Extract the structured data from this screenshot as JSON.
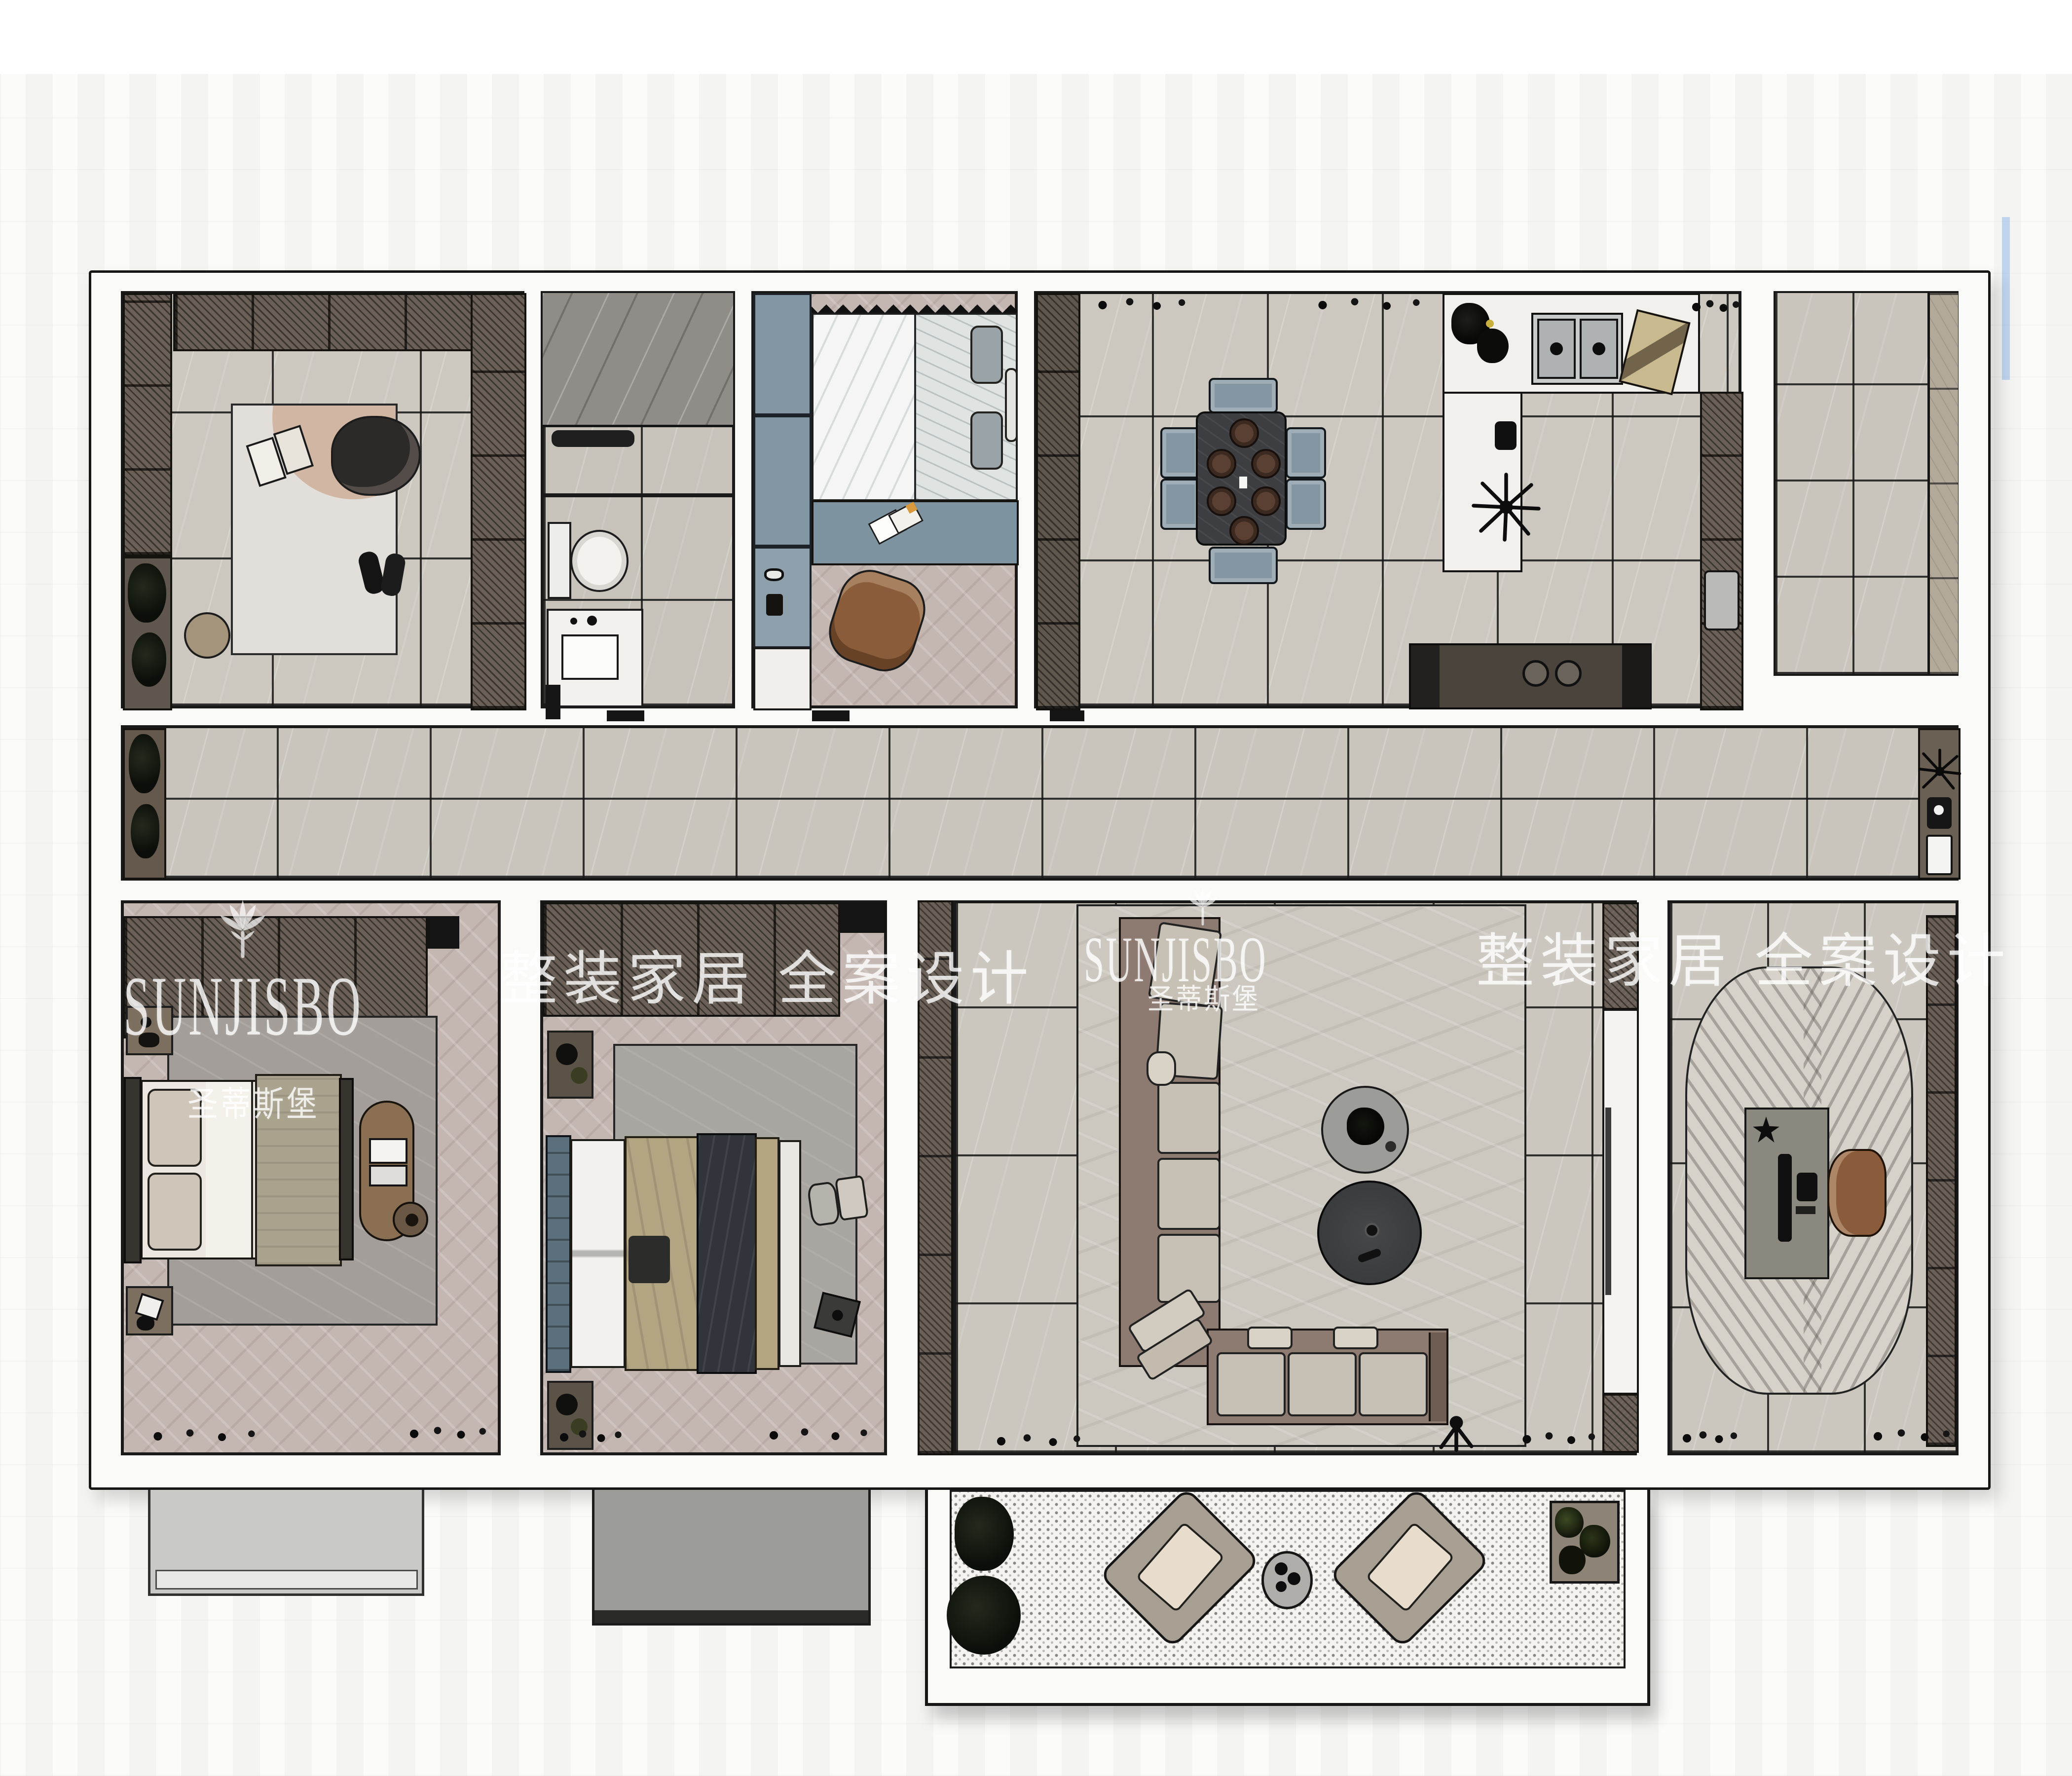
{
  "watermarks": {
    "brand": "SUNJISBO",
    "brand_cn": "圣蒂斯堡",
    "slogan": "整装家居 全案设计"
  },
  "palette": {
    "background": "#f7f7f5",
    "wall_fill": "#fafaf8",
    "wall_line": "#161616",
    "tile_floor": "#cbc7bf",
    "herringbone_floor": "#c4b7b2",
    "dark_shower_marble": "#908d88",
    "wardrobe_wood": "#6a6057",
    "cabinet_blue": "#8296a3",
    "desk_blue": "#7e93a0",
    "sofa_base": "#8d7a70",
    "cushion": "#c7c0b4",
    "leather_brown": "#8a5c3b",
    "dining_table": "#3c3e42",
    "watermark_text": "rgba(255,255,255,0.8)"
  }
}
